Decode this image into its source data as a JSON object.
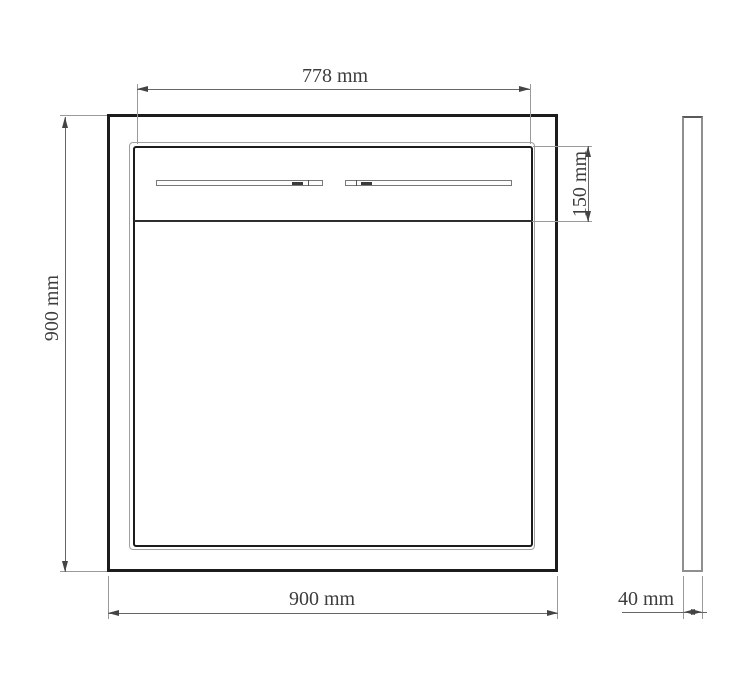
{
  "drawing": {
    "front_view": {
      "inner_width_label": "778 mm",
      "top_section_height_label": "150 mm",
      "height_label": "900 mm",
      "width_label": "900 mm"
    },
    "side_view": {
      "depth_label": "40 mm"
    },
    "colors": {
      "object_line": "#1c1c1c",
      "dimension_line": "#666666",
      "background": "#ffffff"
    }
  }
}
